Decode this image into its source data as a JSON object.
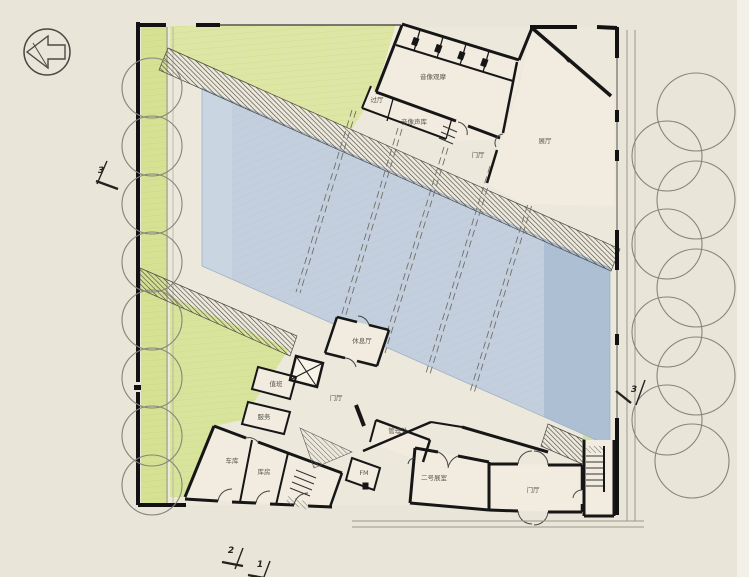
{
  "document": {
    "type": "architectural-floor-plan",
    "description": "Scanned hand-rendered ground floor plan with colored pencil: large water court, hatched ramp walls, tree rows, north arrow and section marks"
  },
  "colors": {
    "paper": "#eae5d9",
    "green_planting": "#d8e298",
    "water_light": "#c4cfde",
    "water_deep": "#aabdd2",
    "wall": "#161616",
    "tree_outline": "#85857b"
  },
  "north_arrow": {
    "present": true,
    "direction": "left"
  },
  "section_markers": [
    {
      "label": "3",
      "position": "left"
    },
    {
      "label": "3",
      "position": "right"
    },
    {
      "label": "2",
      "position": "bottom"
    },
    {
      "label": "1",
      "position": "bottom"
    }
  ],
  "room_labels": [
    {
      "text": "音像观摩",
      "x": 433,
      "y": 77
    },
    {
      "text": "过厅",
      "x": 377,
      "y": 100
    },
    {
      "text": "音像声库",
      "x": 414,
      "y": 122
    },
    {
      "text": "门厅",
      "x": 478,
      "y": 155
    },
    {
      "text": "展厅",
      "x": 545,
      "y": 141
    },
    {
      "text": "休息厅",
      "x": 362,
      "y": 341
    },
    {
      "text": "值班",
      "x": 276,
      "y": 384
    },
    {
      "text": "门厅",
      "x": 336,
      "y": 398
    },
    {
      "text": "服务",
      "x": 264,
      "y": 417
    },
    {
      "text": "管理处",
      "x": 398,
      "y": 431
    },
    {
      "text": "车库",
      "x": 232,
      "y": 461
    },
    {
      "text": "库房",
      "x": 264,
      "y": 472
    },
    {
      "text": "FM",
      "x": 364,
      "y": 473
    },
    {
      "text": "二号展室",
      "x": 434,
      "y": 478
    },
    {
      "text": "门厅",
      "x": 533,
      "y": 490
    }
  ],
  "landscape": {
    "left_tree_count": 8,
    "right_tree_count": 9
  }
}
